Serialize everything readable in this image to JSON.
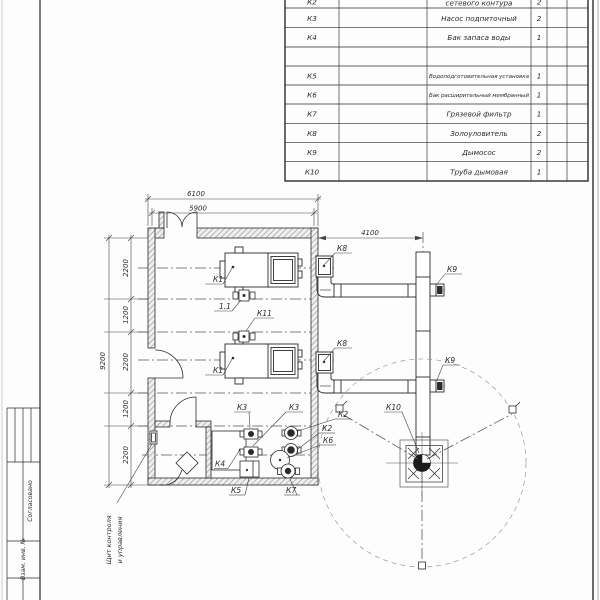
{
  "sheet": {
    "type": "boiler-room plan drawing"
  },
  "spec_table": {
    "rows": [
      {
        "pos": "К2",
        "name": "сетевого контура",
        "qty": "2"
      },
      {
        "pos": "К3",
        "name": "Насос подпиточный",
        "qty": "2"
      },
      {
        "pos": "К4",
        "name": "Бак запаса воды",
        "qty": "1"
      },
      {
        "pos": "",
        "name": "",
        "qty": ""
      },
      {
        "pos": "К5",
        "name": "Водоподготовительная установка",
        "qty": "1"
      },
      {
        "pos": "К6",
        "name": "Бак расширительный мембранный",
        "qty": "1"
      },
      {
        "pos": "К7",
        "name": "Грязевой фильтр",
        "qty": "1"
      },
      {
        "pos": "К8",
        "name": "Золоуловитель",
        "qty": "2"
      },
      {
        "pos": "К9",
        "name": "Дымосос",
        "qty": "2"
      },
      {
        "pos": "К10",
        "name": "Труба дымовая",
        "qty": "1"
      }
    ]
  },
  "dimensions": {
    "top_outer": "6100",
    "top_inner": "5900",
    "flue": "4100",
    "left_overall": "9200",
    "seg1": "2200",
    "seg2": "1200",
    "seg3": "2200",
    "seg4": "1200",
    "seg5": "2200"
  },
  "labels": {
    "k1a": "К1",
    "k1b": "К1",
    "p11": "1.1",
    "k11": "К11",
    "k3a": "К3",
    "k3b": "К3",
    "k2a": "К2",
    "k2b": "К2",
    "k6": "К6",
    "k4": "К4",
    "k5": "К5",
    "k7": "К7",
    "k8a": "К8",
    "k8b": "К8",
    "k9a": "К9",
    "k9b": "К9",
    "k10": "К10",
    "panel_line1": "Щит контроля",
    "panel_line2": "и управления"
  },
  "title_block": {
    "approved": "Согласовано",
    "inv": "Взам. инв. №"
  },
  "colors": {
    "line": "#2b2b2b",
    "axis": "#555555",
    "hatch": "#8a8a8a",
    "circle_dashed": "#999999"
  }
}
